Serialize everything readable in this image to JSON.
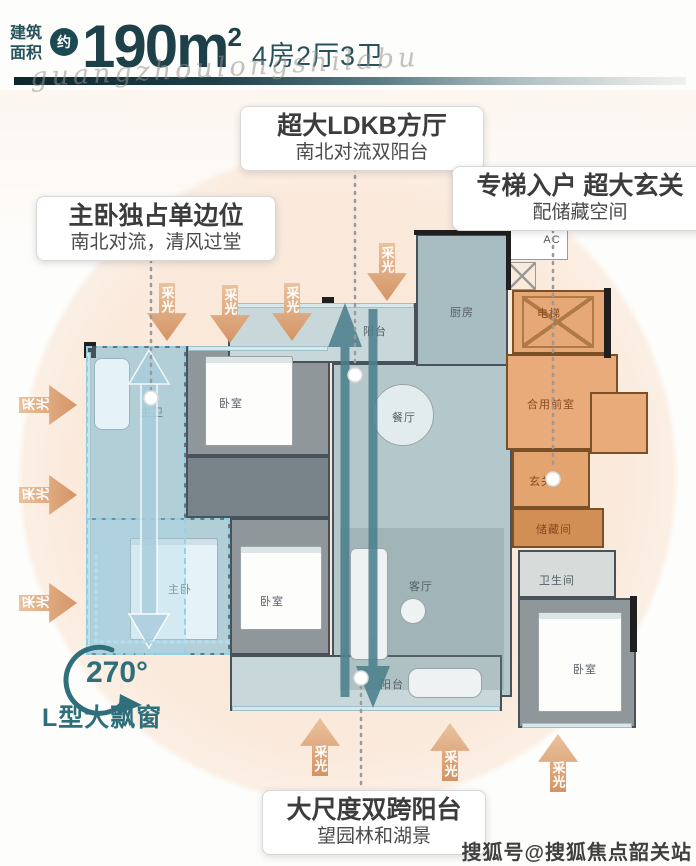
{
  "header": {
    "label_line1": "建筑",
    "label_line2": "面积",
    "approx": "约",
    "value": "190",
    "unit": "m",
    "exponent": "2",
    "layout": "4房2厅3卫",
    "script_watermark": "guangzhoulongshilabu"
  },
  "callouts": {
    "ldkb_title": "超大LDKB方厅",
    "ldkb_sub": "南北对流双阳台",
    "entry_title": "专梯入户 超大玄关",
    "entry_sub": "配储藏空间",
    "master_title": "主卧独占单边位",
    "master_sub": "南北对流，清风过堂",
    "balcony_title": "大尺度双跨阳台",
    "balcony_sub": "望园林和湖景"
  },
  "bay": {
    "degrees": "270°",
    "label": "L型大飘窗"
  },
  "light_label": "采光",
  "rooms": {
    "kitchen": "厨房",
    "dining": "餐厅",
    "living": "客厅",
    "balcony_top": "阳台",
    "balcony_bottom": "阳台",
    "bedroom": "卧室",
    "master_bedroom": "主卧",
    "master_bath": "主卫",
    "bathroom": "卫生间",
    "elevator": "电梯",
    "shared_lobby": "合用前室",
    "foyer": "玄关",
    "storage": "储藏间",
    "ac": "AC"
  },
  "page": {
    "watermark": "搜狐号@搜狐焦点韶关站"
  },
  "colors": {
    "accent_teal": "#1d4a52",
    "zone_orange": "#e6a877",
    "light_arrow_orange": "#d49465",
    "flow_arrow_teal": "#4c808d",
    "highlight_blue": "#8fd0e2"
  }
}
